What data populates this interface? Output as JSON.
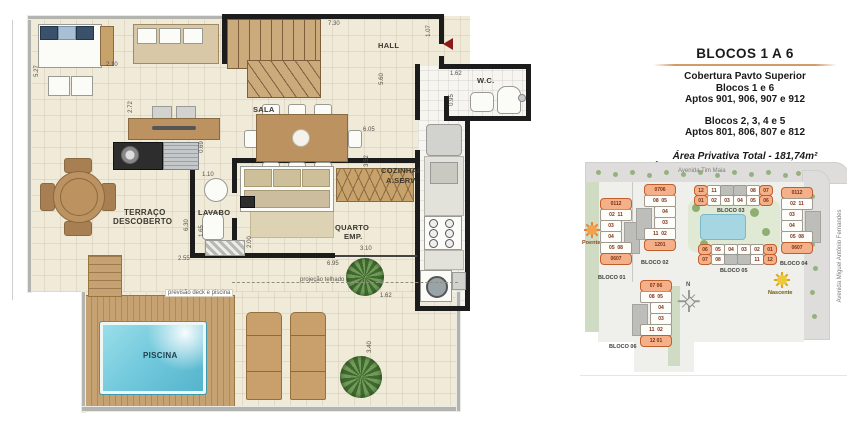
{
  "floor_plan": {
    "rooms": {
      "hall": "HALL",
      "sala": "SALA",
      "wc": "W.C.",
      "cozinha_line1": "COZINHA/",
      "cozinha_line2": "A.SERV.",
      "lavabo": "LAVABO",
      "quarto_line1": "QUARTO",
      "quarto_line2": "EMP.",
      "terraco_line1": "TERRAÇO",
      "terraco_line2": "DESCOBERTO",
      "piscina": "PISCINA"
    },
    "notes": {
      "deck_note": "previsão deck e piscina",
      "roof_note": "projeção telhado"
    },
    "dims": {
      "d730": "7.30",
      "d107": "1.07",
      "d162wc": "1.62",
      "d095": "0.95",
      "d560": "5.60",
      "d605": "6.05",
      "d352": "3.52",
      "d527": "5.27",
      "d210": "2.10",
      "d272": "2.72",
      "d069": "0.69",
      "d110": "1.10",
      "d630": "6.30",
      "d165": "1.65",
      "d200": "2.00",
      "d255": "2.55",
      "d310": "3.10",
      "d695": "6.95",
      "d162deck": "1.62",
      "d340": "3.40"
    }
  },
  "info_panel": {
    "title": "BLOCOS 1 A 6",
    "line1": "Cobertura Pavto Superior",
    "line2": "Blocos 1 e 6",
    "line3": "Aptos 901, 906, 907 e 912",
    "line4": "Blocos 2, 3, 4 e 5",
    "line5": "Aptos 801, 806, 807 e 812",
    "area1": "Área Privativa Total - 181,74m²",
    "area2": "Área Privativa Pavto Superior - 90,69m²"
  },
  "site_plan": {
    "street_top": "Avenida Tim Maia",
    "street_right": "Avenida Miguel Antônio Fernandes",
    "sun_west": "Poente",
    "sun_east": "Nascente",
    "compass_n": "N",
    "blocks": {
      "b1": {
        "label": "BLOCO 01",
        "c1": "0112",
        "c2": "02  11",
        "c3": "03",
        "c4": "04",
        "c5": "05  08",
        "c6": "0607"
      },
      "b2": {
        "label": "BLOCO 02",
        "c1": "0706",
        "c2": "08  05",
        "c3": "04",
        "c4": "03",
        "c5": "11  02",
        "c6": "1201"
      },
      "b3": {
        "label": "BLOCO 03",
        "t1": "12",
        "t2": "11",
        "t3": "08",
        "t4": "07",
        "u1": "01",
        "u2": "02",
        "u3": "03",
        "u4": "04",
        "u5": "05",
        "u6": "06"
      },
      "b4": {
        "label": "BLOCO 04",
        "c1": "0112",
        "c2": "02  11",
        "c3": "03",
        "c4": "04",
        "c5": "05  08",
        "c6": "0607"
      },
      "b5": {
        "label": "BLOCO 05",
        "t1": "06",
        "t2": "05",
        "t3": "04",
        "t4": "03",
        "t5": "02",
        "t6": "01",
        "u1": "07",
        "u2": "08",
        "u3": "11",
        "u4": "12"
      },
      "b6": {
        "label": "BLOCO 06",
        "c1": "07 06",
        "c2": "08  05",
        "c3": "04",
        "c4": "03",
        "c5": "11  02",
        "c6": "12 01"
      }
    }
  },
  "colors": {
    "highlight_orange": "#f4b088",
    "pool_blue": "#74cadd",
    "deck_wood": "#c6a172",
    "wall_black": "#1c1c1c",
    "entry_arrow_red": "#8b1a1a",
    "sun_west": "#e8823a",
    "sun_east": "#f0c020",
    "title_rule": "#d39a6a"
  }
}
